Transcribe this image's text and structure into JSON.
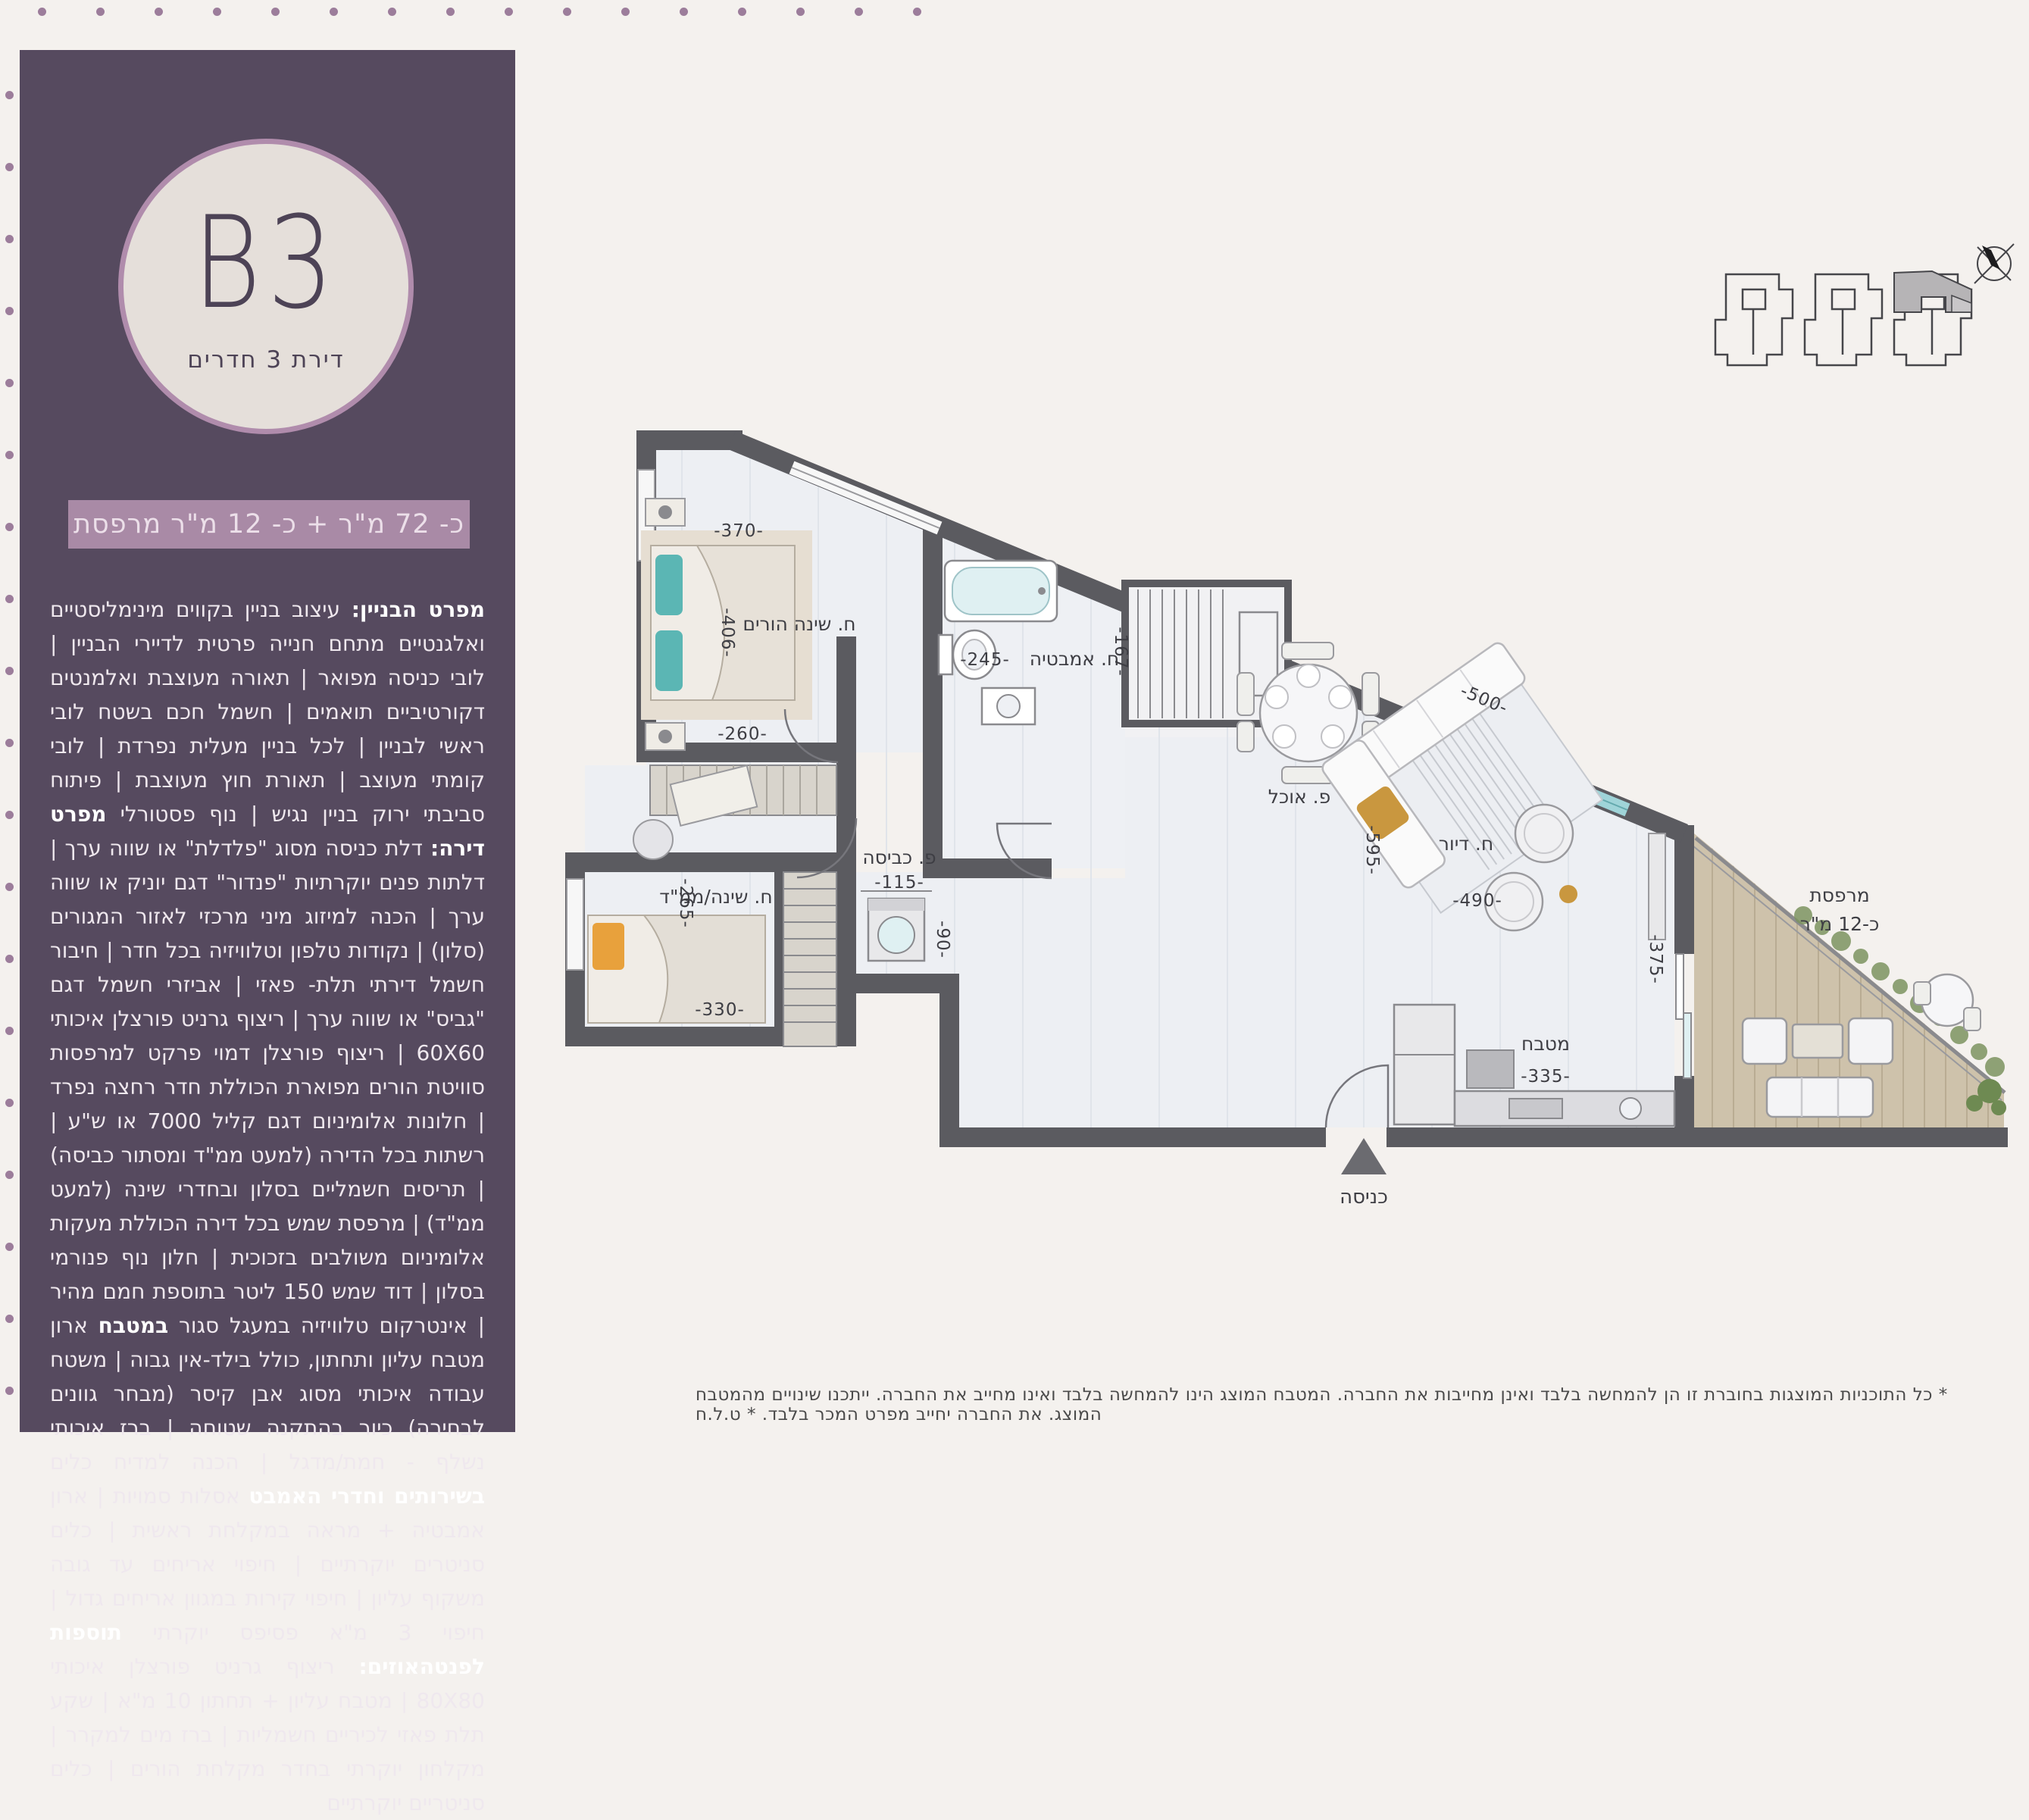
{
  "colors": {
    "page_bg": "#f4f1ee",
    "sidebar_bg": "#564a5f",
    "circle_fill": "#e5dfda",
    "circle_ring": "#b08cac",
    "banner_bg": "#a98aa6",
    "dots": "#9c7d9b",
    "wall": "#5b5b60",
    "floor": "#edeff3",
    "deck": "#cec2ab",
    "window_teal": "#9fd4d8",
    "accent_gold": "#c9973f",
    "accent_teal": "#5bb6b4",
    "accent_orange": "#e8a13c"
  },
  "sidebar": {
    "unit_code": "B3",
    "unit_subtitle": "דירת 3 חדרים",
    "area_banner": "כ- 72 מ\"ר + כ- 12 מ\"ר מרפסת",
    "specs": [
      {
        "b": true,
        "t": "מפרט הבניין:"
      },
      {
        "b": false,
        "t": " עיצוב בניין בקווים מינימליסטיים ואלגנטיים מתחם חנייה פרטית לדיירי הבניין | לובי כניסה מפואר | תאורה מעוצבת ואלמנטים דקורטיביים תואמים | חשמל חכם בשטח לובי ראשי לבניין | לכל בניין מעלית נפרדת | לובי קומתי מעוצב | תאורת חוץ מעוצבת | פיתוח סביבתי ירוק בניין נגיש | נוף פסטורלי "
      },
      {
        "b": true,
        "t": "מפרט דירה:"
      },
      {
        "b": false,
        "t": " דלת כניסה מסוג \"פלדלת\" או שווה ערך | דלתות פנים יוקרתיות \"פנדור\" דגם יוניק או שווה ערך | הכנה למיזוג מיני מרכזי לאזור המגורים (סלון) | נקודות טלפון וטלוויזיה בכל חדר | חיבור חשמל דירתי תלת- פאזי | אביזרי חשמל דגם \"גביס\" או שווה ערך | ריצוף גרניט פורצלן איכותי 60X60 | ריצוף פורצלן דמוי פרקט למרפסות סוויטת הורים מפוארת הכוללת חדר רחצה נפרד | חלונות אלומיניום דגם קליל 7000 או ש\"ע | רשתות בכל הדירה (למעט ממ\"ד ומסתור כביסה) | תריסים חשמליים בסלון ובחדרי שינה (למעט ממ\"ד) | מרפסת שמש בכל דירה הכוללת מעקות אלומיניום משולבים בזכוכית | חלון נוף פנורמי בסלון | דוד שמש 150 ליטר בתוספת חמם מהיר | אינטרקום טלוויזיה במעגל סגור "
      },
      {
        "b": true,
        "t": "במטבח"
      },
      {
        "b": false,
        "t": " ארון מטבח עליון ותחתון, כולל בילד-אין גבוה | משטח עבודה איכותי מסוג אבן קיסר (מבחר גוונים לבחירה) כיור בהתקנה שטוחה | ברז איכותי נשלף - חמת/מדגל | הכנה למדיח כלים "
      },
      {
        "b": true,
        "t": "בשירותים וחדרי האמבט"
      },
      {
        "b": false,
        "t": " אסלות סמויות | ארון אמבטיה + מראה במקלחת ראשית | כלים סניטרים יוקרתיים | חיפוי אריחים עד גובה משקוף עליון | חיפוי קירות במגוון אריחים גדול | חיפוי 3 מ\"א פסיפס יוקרתי "
      },
      {
        "b": true,
        "t": "תוספות לפנטהאוזים:"
      },
      {
        "b": false,
        "t": " ריצוף גרניט פורצלן איכותי 80X80 | מטבח עליון + תחתון 10 מ\"א | שקע תלת פאזי לכיריים חשמליות | ברז מים למקרר | מקלחון יוקרתי בחדר מקלחת הורים | כלים סניטריים יוקרתיים"
      }
    ]
  },
  "plan": {
    "labels": {
      "master_bedroom": "ח. שינה הורים",
      "bathroom": "ח. אמבטיה",
      "bedroom2": "ח. שינה/ממ\"ד",
      "living": "ח. דיור",
      "kitchen": "מטבח",
      "dining": "פ. אוכל",
      "laundry": "פ. כביסה",
      "balcony_line1": "מרפסת",
      "balcony_line2": "כ-12 מ\"ר",
      "entrance": "כניסה"
    },
    "dims": {
      "d370": "-370-",
      "d406": "-406-",
      "d260": "-260-",
      "d245": "-245-",
      "d167": "-167-",
      "d265": "-265-",
      "d330": "-330-",
      "d115": "-115-",
      "d90": "-90-",
      "d500": "-500-",
      "d595": "-595-",
      "d490": "-490-",
      "d375": "-375-",
      "d335": "-335-"
    }
  },
  "footer": {
    "disclaimer": "* כל התוכניות המוצגות בחוברת זו הן להמחשה בלבד ואינן מחייבות את החברה. המטבח המוצג הינו להמחשה בלבד ואינו מחייב את החברה. ייתכנו שינויים מהמטבח המוצג. את החברה יחייב מפרט המכר בלבד. * ט.ל.ח"
  }
}
